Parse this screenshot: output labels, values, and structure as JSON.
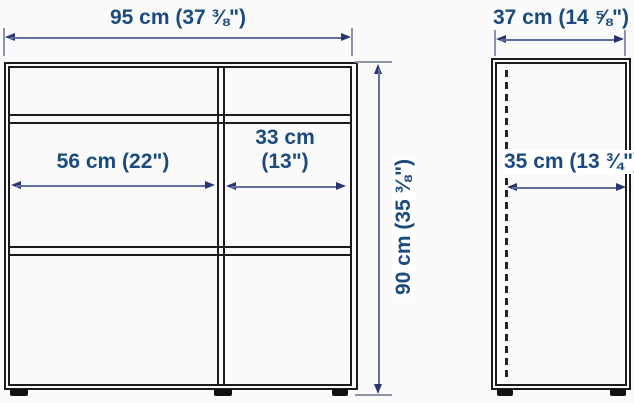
{
  "diagram_title": "cabinet-dimension-diagram",
  "front_view": {
    "width_label": "95 cm (37 ⅜\")",
    "height_label": "90 cm (35 ⅜\")",
    "left_compartment_width_label": "56 cm (22\")",
    "right_compartment_width_label_line1": "33 cm",
    "right_compartment_width_label_line2": "(13\")"
  },
  "side_view": {
    "width_label": "37 cm (14 ⅝\")",
    "depth_label": "35 cm (13 ¾\")"
  },
  "colors": {
    "dimension_text": "#1b4a7e",
    "arrow_line": "#5f6fa0",
    "arrow_head": "#28366f",
    "outline": "#1c1c1c",
    "background": "#fafafa"
  }
}
